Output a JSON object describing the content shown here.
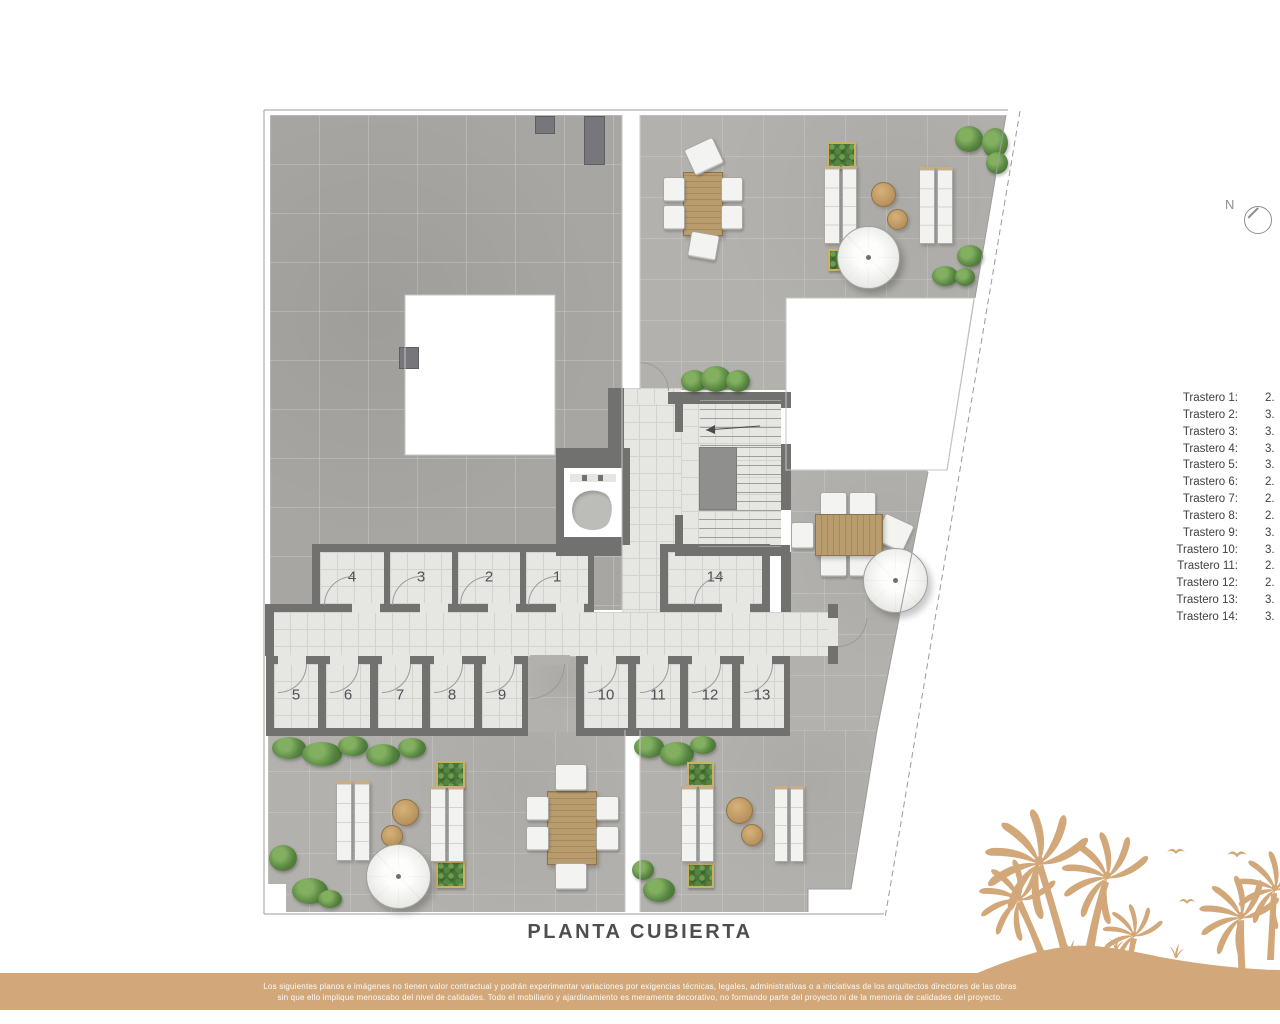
{
  "title": "PLANTA CUBIERTA",
  "compass": {
    "label": "N"
  },
  "rooms": [
    "1",
    "2",
    "3",
    "4",
    "5",
    "6",
    "7",
    "8",
    "9",
    "10",
    "11",
    "12",
    "13",
    "14"
  ],
  "storage_list": {
    "items": [
      {
        "label": "Trastero 1:",
        "value": "2."
      },
      {
        "label": "Trastero 2:",
        "value": "3."
      },
      {
        "label": "Trastero 3:",
        "value": "3."
      },
      {
        "label": "Trastero 4:",
        "value": "3."
      },
      {
        "label": "Trastero 5:",
        "value": "3."
      },
      {
        "label": "Trastero 6:",
        "value": "2."
      },
      {
        "label": "Trastero 7:",
        "value": "2."
      },
      {
        "label": "Trastero 8:",
        "value": "2."
      },
      {
        "label": "Trastero 9:",
        "value": "3."
      },
      {
        "label": "Trastero 10:",
        "value": "3."
      },
      {
        "label": "Trastero 11:",
        "value": "2."
      },
      {
        "label": "Trastero 12:",
        "value": "2."
      },
      {
        "label": "Trastero 13:",
        "value": "3."
      },
      {
        "label": "Trastero 14:",
        "value": "3."
      }
    ]
  },
  "disclaimer": {
    "line1": "Los siguientes planos e imágenes no tienen valor contractual y podrán experimentar variaciones por exigencias técnicas, legales, administrativas o a iniciativas de los arquitectos directores de las obras",
    "line2": "sin que ello implique menoscabo del nivel de calidades. Todo el mobiliario y ajardinamiento es meramente decorativo, no formando parte del proyecto ni de la memoria de calidades del proyecto."
  },
  "colors": {
    "accent_gold": "#d2a87a",
    "wall_gray": "#717170",
    "roof_gray": "#a8a6a2",
    "terrace_gray": "#b3b1ad",
    "interior_tile": "#e6e6e3",
    "plant_green": "#568340",
    "wood_tan": "#b99c6e",
    "text_dark": "#4d4e50"
  }
}
